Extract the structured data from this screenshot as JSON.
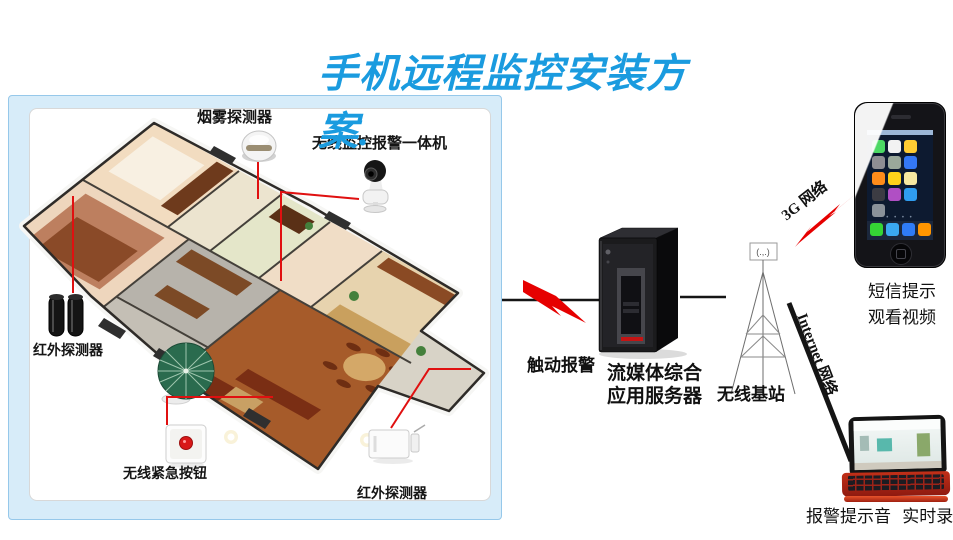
{
  "title": "手机远程监控安装方案.",
  "panel": {
    "labels": {
      "smoke_detector": "烟雾探测器",
      "camera": "无线监控报警一体机",
      "infrared_left": "红外探测器",
      "emergency_button": "无线紧急按钮",
      "infrared_bottom": "红外探测器"
    }
  },
  "flow": {
    "trigger_alarm": "触动报警",
    "server_line1": "流媒体综合",
    "server_line2": "应用服务器",
    "base_station": "无线基站",
    "antenna_symbol": "(.,.)",
    "network_3g": "3G 网络",
    "internet": "Internet 网络"
  },
  "phone": {
    "sms": "短信提示",
    "video": "观看视频"
  },
  "laptop": {
    "caption": "报警提示音 实时录像"
  },
  "colors": {
    "title_blue": "#1a9bdf",
    "alert_red": "#e60000",
    "connector_red": "#e01010",
    "line_black": "#151515",
    "panel_blue": "#d7ecf9"
  }
}
